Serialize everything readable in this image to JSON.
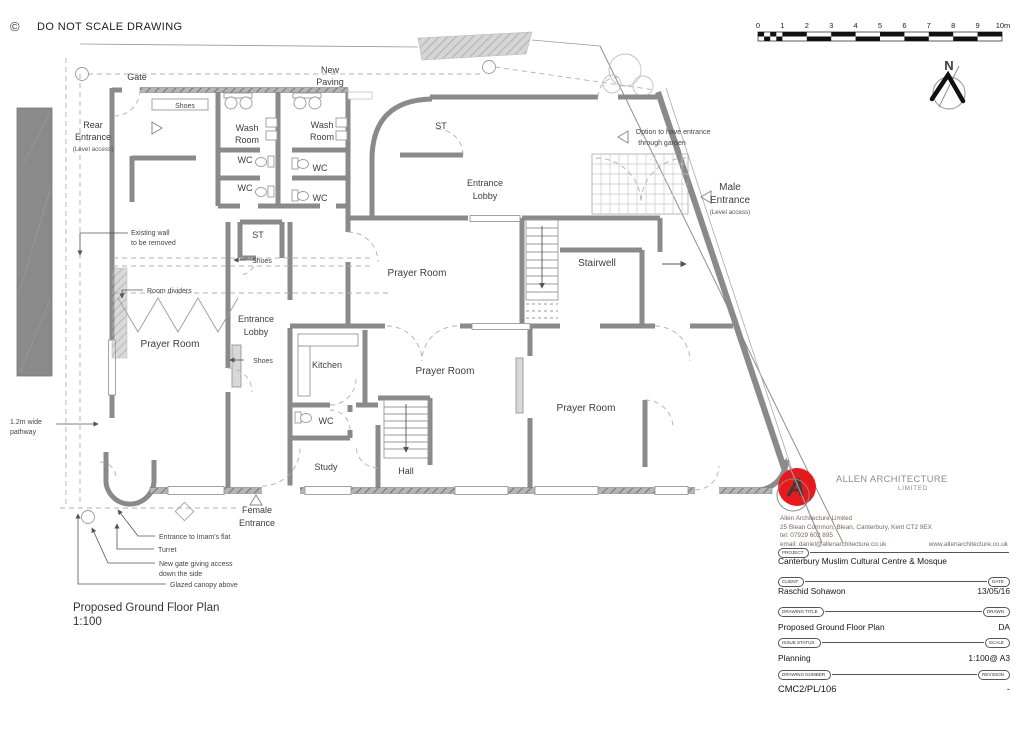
{
  "header": {
    "copyright_symbol": "©",
    "note": "DO NOT SCALE DRAWING"
  },
  "scale_bar": {
    "ticks": [
      "0",
      "1",
      "2",
      "3",
      "4",
      "5",
      "6",
      "7",
      "8",
      "9",
      "10m"
    ]
  },
  "compass": {
    "north_label": "N"
  },
  "plan_labels": {
    "gate": "Gate",
    "new_paving_l1": "New",
    "new_paving_l2": "Paving",
    "shoes_top": "Shoes",
    "rear_entrance_l1": "Rear",
    "rear_entrance_l2": "Entrance",
    "rear_entrance_l3": "(Level access)",
    "wash_room_a_l1": "Wash",
    "wash_room_a_l2": "Room",
    "wash_room_b_l1": "Wash",
    "wash_room_b_l2": "Room",
    "wc_a1": "WC",
    "wc_a2": "WC",
    "wc_b1": "WC",
    "wc_b2": "WC",
    "st_top": "ST",
    "entrance_lobby_main_l1": "Entrance",
    "entrance_lobby_main_l2": "Lobby",
    "option_l1": "Option to have entrance",
    "option_l2": "through garden",
    "male_entrance_l1": "Male",
    "male_entrance_l2": "Entrance",
    "male_entrance_l3": "(Level access)",
    "existing_wall_l1": "Existing wall",
    "existing_wall_l2": "to be removed",
    "st_mid": "ST",
    "shoes_st": "Shoes",
    "prayer_room_top": "Prayer Room",
    "stairwell": "Stairwell",
    "room_dividers": "Room dividers",
    "entrance_lobby_2_l1": "Entrance",
    "entrance_lobby_2_l2": "Lobby",
    "prayer_room_left": "Prayer Room",
    "shoes_lobby": "Shoes",
    "kitchen": "Kitchen",
    "prayer_room_mid": "Prayer Room",
    "prayer_room_right": "Prayer Room",
    "pathway_l1": "1.2m wide",
    "pathway_l2": "pathway",
    "wc_study": "WC",
    "study": "Study",
    "hall": "Hall",
    "female_entrance_l1": "Female",
    "female_entrance_l2": "Entrance",
    "imams_flat": "Entrance to Imam's flat",
    "turret": "Turret",
    "new_gate_l1": "New gate giving access",
    "new_gate_l2": "down the side",
    "glazed_canopy": "Glazed canopy above",
    "plan_title_l1": "Proposed Ground Floor Plan",
    "plan_title_l2": "1:100"
  },
  "title_block": {
    "logo_letter": "A",
    "brand_name": "ALLEN ARCHITECTURE",
    "brand_suffix": "LIMITED",
    "address_line1": "Allen Architecture Limited",
    "address_line2": "25 Blean Common, Blean, Canterbury, Kent CT2 9EX",
    "address_line3": "tel: 07929 602 895",
    "address_line4_email": "email: daniel@allenarchitecture.co.uk",
    "address_line4_web": "www.allenarchitecture.co.uk",
    "project_label": "PROJECT",
    "project_value": "Canterbury Muslim Cultural Centre & Mosque",
    "client_label": "CLIENT",
    "client_value": "Raschid Sohawon",
    "date_label": "DATE",
    "date_value": "13/05/16",
    "drawing_title_label": "DRAWING TITLE",
    "drawing_title_value": "Proposed Ground Floor Plan",
    "drawn_label": "DRAWN",
    "drawn_value": "DA",
    "issue_status_label": "ISSUE STATUS",
    "issue_status_value": "Planning",
    "scale_label": "SCALE",
    "scale_value": "1:100@ A3",
    "drawing_number_label": "DRAWING NUMBER",
    "drawing_number_value": "CMC2/PL/106",
    "revision_label": "REVISION",
    "revision_value": "-"
  },
  "colors": {
    "wall": "#8a8a8a",
    "logo_red": "#e8191c",
    "annotation": "#454545",
    "address_text": "#7b6560"
  }
}
